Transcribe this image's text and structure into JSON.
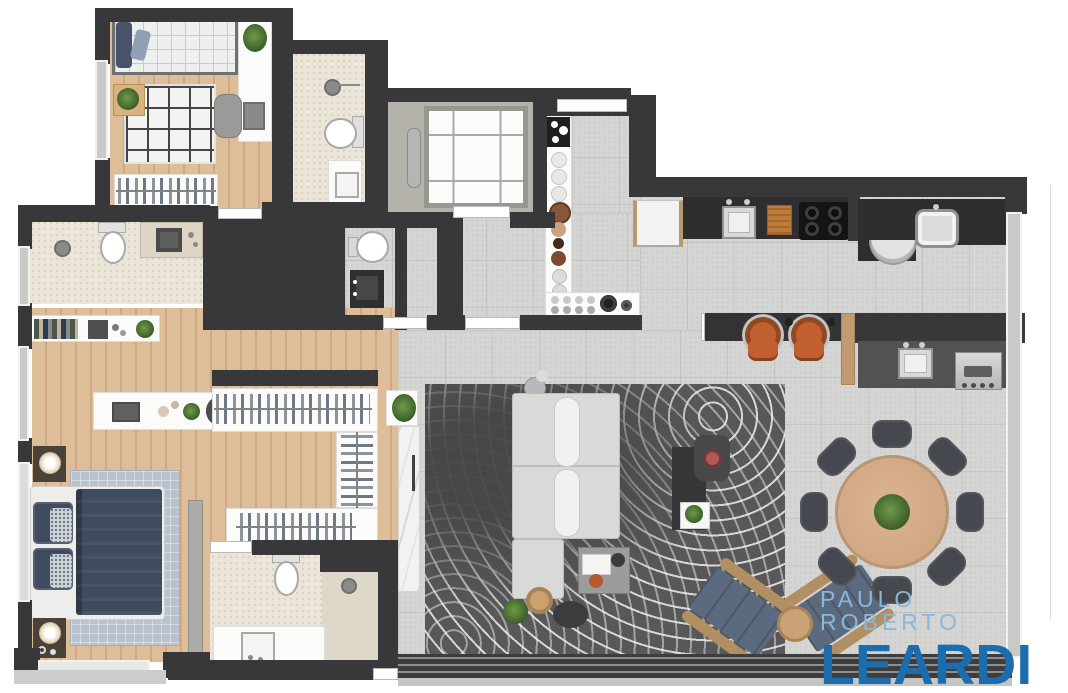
{
  "watermark": {
    "line1": "PAULO ROBERTO",
    "line2": "LEARDI"
  },
  "palette": {
    "wall": "#38383a",
    "wood_floor": "#debd99",
    "wood_floor_dark": "#cfa983",
    "tile_floor": "#d5d5d4",
    "tile_line": "#c6c6c5",
    "bath_floor": "#eae5d8",
    "bath_speck": "#d8d1bd",
    "elevator_floor": "#b5b1ab",
    "counter_dark": "#2e2e30",
    "rug_living": "#585858",
    "sofa": "#d9d9d7",
    "dining_wood": "#d5ac8c",
    "chair_dark": "#45484e",
    "stool_orange": "#c2602f",
    "lounge_blue": "#5b6a7e",
    "lounge_wood": "#b28f63",
    "bed_navy": "#3f4b5e",
    "rug_bedroom": "#b9c2cf",
    "marble": "#f2f2f0",
    "watermark_light": "#8cb6da",
    "watermark_dark": "#1c6dad"
  },
  "icons": {
    "toilet": "css-ellipse-with-tank",
    "shower-head": "css-circle-with-arm",
    "sink": "css-inset-square",
    "stove-burners": "css-four-dots",
    "washing-machine": "css-half-circle",
    "elevator": "css-cross-square",
    "plant": "css-radial-green",
    "bbq-grill": "css-metal-slot",
    "clothes-hangers": "css-stripe-pattern"
  }
}
